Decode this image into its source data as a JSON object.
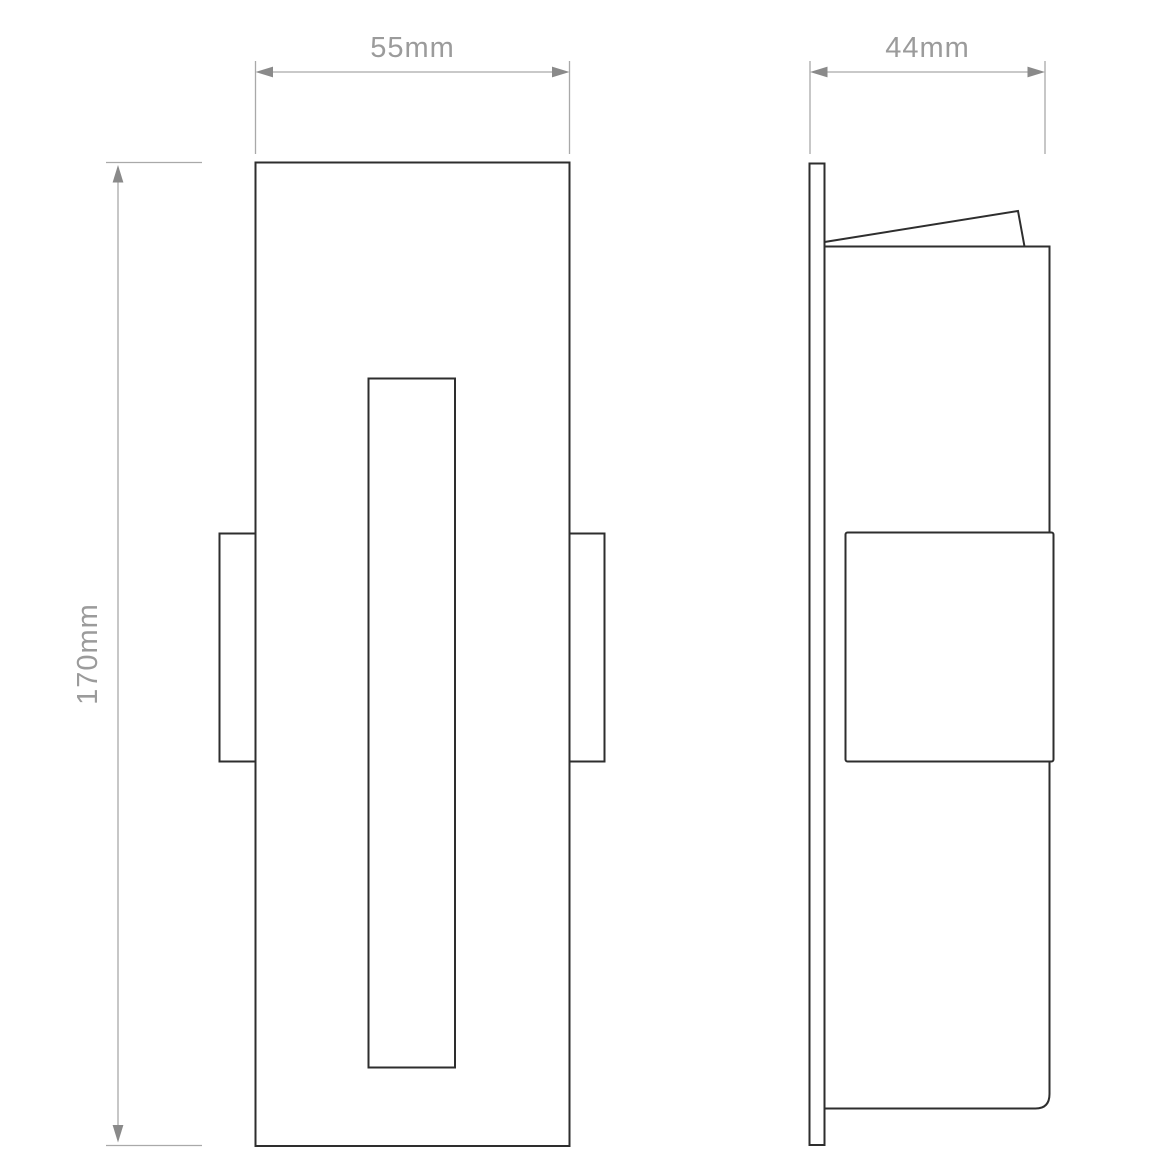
{
  "theme": {
    "background": "#ffffff",
    "outline": "#2e2e2e",
    "dimension_line": "#a9a9a9",
    "arrow": "#8a8a8a",
    "label": "#9b9b9b"
  },
  "diagram": {
    "type": "technical-dimension-drawing",
    "views": {
      "front": "front elevation with vertical light slot and two side fixing tabs",
      "side": "side elevation with wall plate, open hinged lid and recessed body"
    },
    "dimensions": {
      "width": "55mm",
      "depth": "44mm",
      "height": "170mm"
    }
  }
}
